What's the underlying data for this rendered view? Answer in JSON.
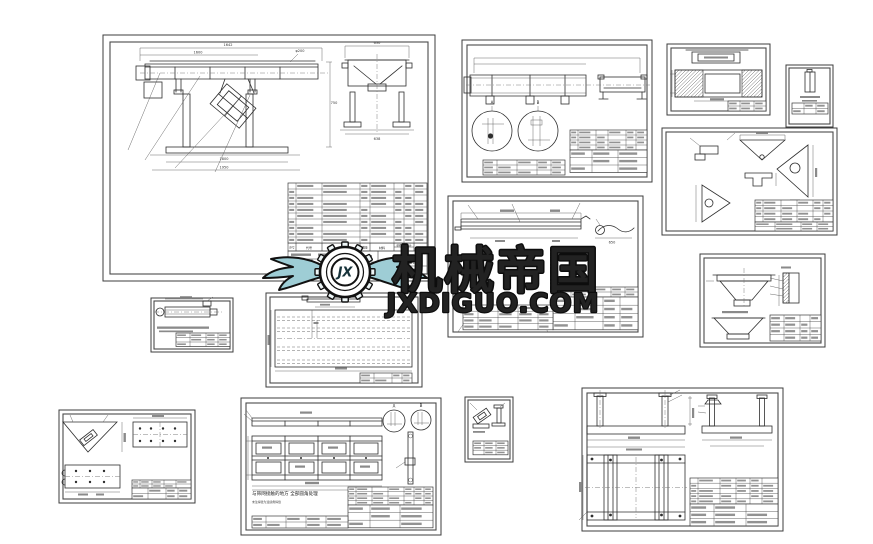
{
  "watermark": {
    "monogram": "JX",
    "brand": "机械帝国",
    "site": "JXDIGUO.COM",
    "teal": "#4e97a4",
    "teal_dark": "#2c6f7e",
    "teal_light": "#c2e2e7"
  },
  "colors": {
    "line": "#2e2e2e",
    "thin_line": "#5a5a5a",
    "sheet_border": "#3c3c3c"
  },
  "details": {
    "a": "A",
    "b": "B"
  },
  "sheets": {
    "main_assembly": {
      "dims": {
        "overall_top": "1642",
        "deck": "1600",
        "flange": "φ200",
        "height": "750",
        "base": "1800",
        "base_overall": "1950",
        "end_top": "630",
        "end_bottom": "638"
      },
      "bom_headers": {
        "seq": "序号",
        "code": "代号",
        "name": "名称",
        "qty": "数量",
        "material": "材料",
        "unit": "单件",
        "total": "总计",
        "weight": "重量",
        "remark": "备注"
      },
      "title_block": {
        "city": "新乡市",
        "company": "天丰振动机械有限公司"
      }
    },
    "flat_bar": {
      "dims": {
        "length": "650"
      }
    },
    "panel_frame": {
      "note_main": "与筛网接触的地方 全部圆角处理",
      "note_sub": "未注焊缝为连续角焊缝"
    }
  }
}
